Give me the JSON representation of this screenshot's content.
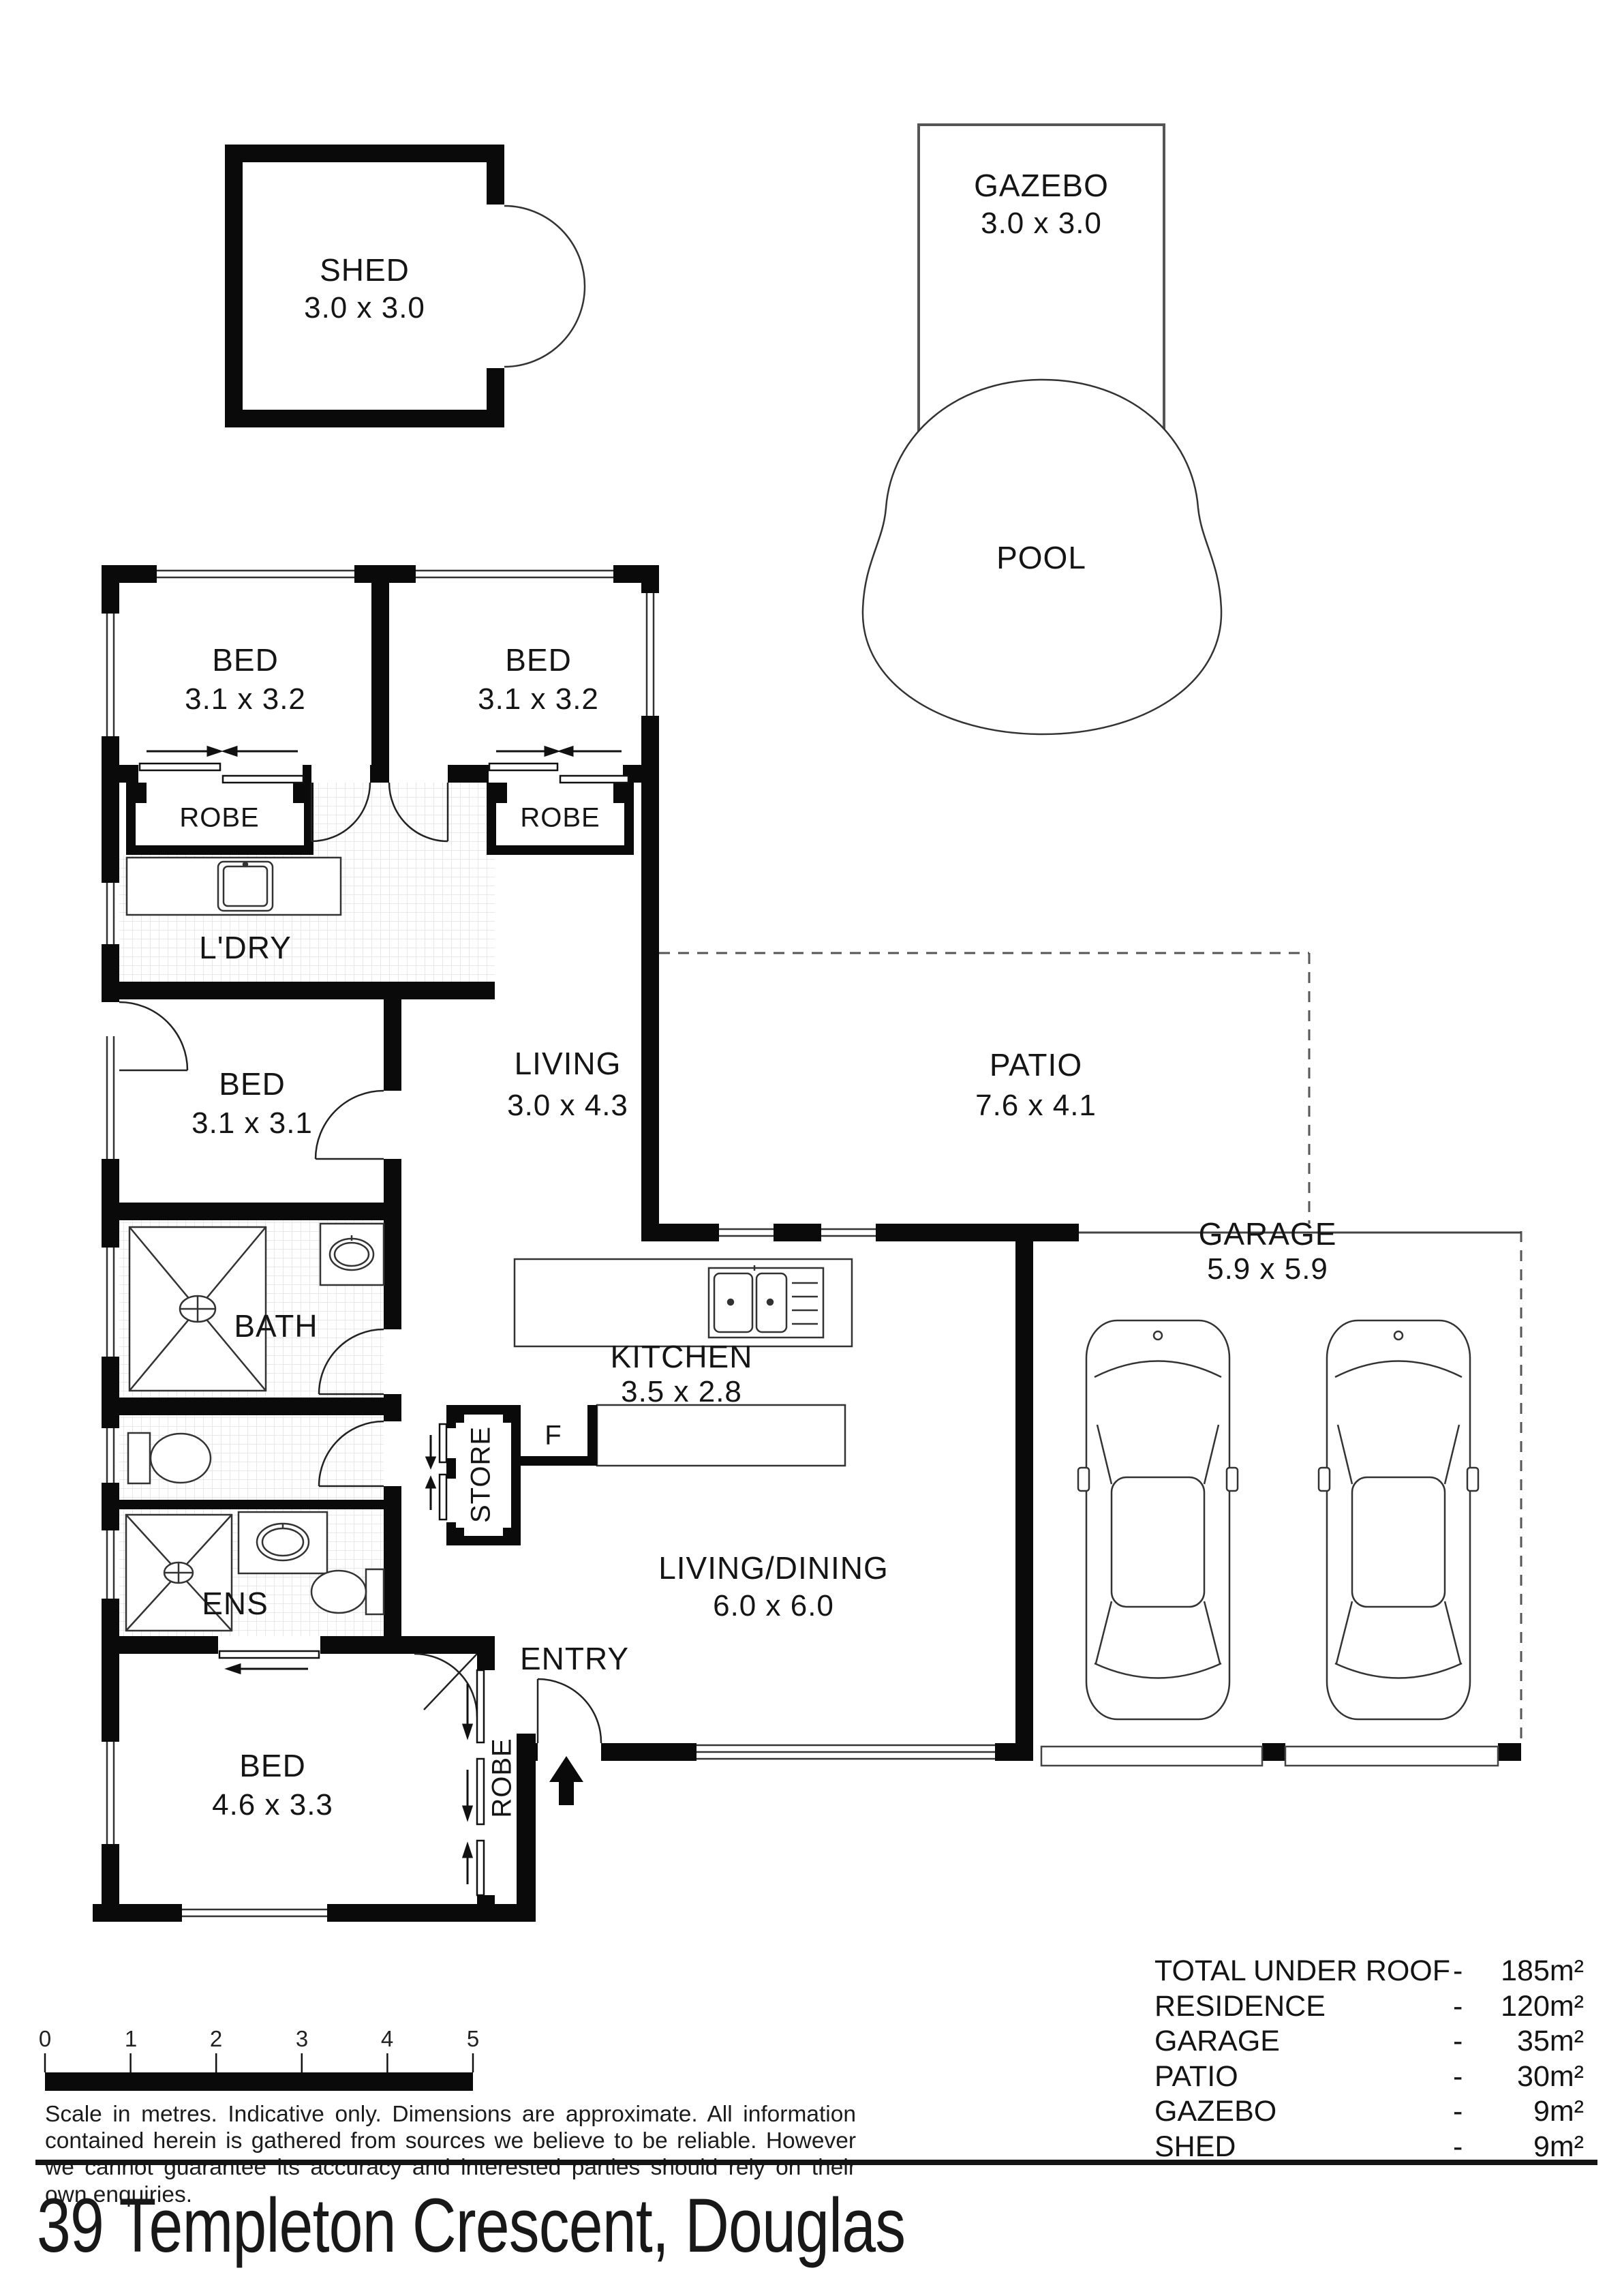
{
  "title": "39 Templeton Crescent, Douglas",
  "outbuildings": {
    "shed": {
      "name": "SHED",
      "dims": "3.0 x 3.0"
    },
    "gazebo": {
      "name": "GAZEBO",
      "dims": "3.0 x 3.0"
    },
    "pool": {
      "name": "POOL"
    }
  },
  "rooms": {
    "bed1": {
      "name": "BED",
      "dims": "3.1 x 3.2"
    },
    "bed2": {
      "name": "BED",
      "dims": "3.1 x 3.2"
    },
    "robe1": {
      "name": "ROBE"
    },
    "robe2": {
      "name": "ROBE"
    },
    "laundry": {
      "name": "L'DRY"
    },
    "living": {
      "name": "LIVING",
      "dims": "3.0 x 4.3"
    },
    "patio": {
      "name": "PATIO",
      "dims": "7.6 x 4.1"
    },
    "bed3": {
      "name": "BED",
      "dims": "3.1 x 3.1"
    },
    "bath": {
      "name": "BATH"
    },
    "ens": {
      "name": "ENS"
    },
    "bed4": {
      "name": "BED",
      "dims": "4.6 x 3.3"
    },
    "robe4": {
      "name": "ROBE"
    },
    "entry": {
      "name": "ENTRY"
    },
    "store": {
      "name": "STORE"
    },
    "fridge": {
      "name": "F"
    },
    "kitchen": {
      "name": "KITCHEN",
      "dims": "3.5 x 2.8"
    },
    "living_dining": {
      "name": "LIVING/DINING",
      "dims": "6.0 x 6.0"
    },
    "garage": {
      "name": "GARAGE",
      "dims": "5.9 x 5.9"
    }
  },
  "footer": {
    "scale_ticks": [
      "0",
      "1",
      "2",
      "3",
      "4",
      "5"
    ],
    "disclaimer": "Scale in metres. Indicative only. Dimensions are approximate. All information contained herein is gathered from sources we believe to be reliable. However we cannot guarantee its accuracy and interested parties should rely on their own enquiries."
  },
  "area_table": {
    "separator": "-",
    "rows": [
      {
        "label": "TOTAL UNDER ROOF",
        "value": "185m²"
      },
      {
        "label": "RESIDENCE",
        "value": "120m²"
      },
      {
        "label": "GARAGE",
        "value": "35m²"
      },
      {
        "label": "PATIO",
        "value": "30m²"
      },
      {
        "label": "GAZEBO",
        "value": "9m²"
      },
      {
        "label": "SHED",
        "value": "9m²"
      }
    ]
  }
}
